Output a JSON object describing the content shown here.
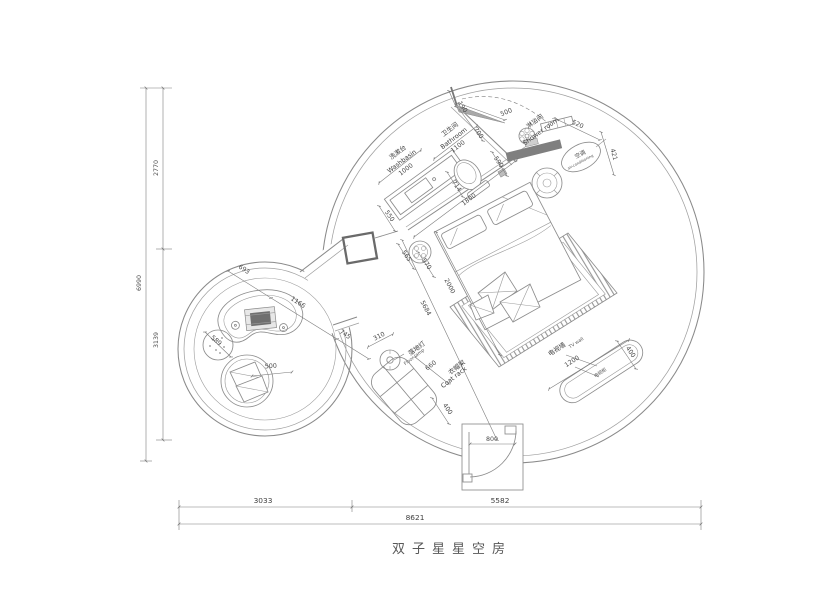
{
  "title": "双子星星空房",
  "colors": {
    "ink": "#6e6e6e",
    "paper": "#ffffff"
  },
  "rooms": {
    "washbasin": {
      "cn": "洗漱台",
      "en": "Washbasin",
      "dim": "1000"
    },
    "bathroom": {
      "cn": "卫生间",
      "en": "Bathroom",
      "dim": "1100"
    },
    "shower": {
      "cn": "淋浴间",
      "en": "Shower room"
    },
    "ac": {
      "cn": "空调",
      "en": "air-conditioning"
    },
    "floor_lamp": {
      "cn": "落地灯",
      "en": "Floor lamp"
    },
    "coat_rack": {
      "cn": "衣帽架",
      "en": "Coat rack"
    },
    "tv_wall": {
      "cn": "电视墙",
      "en": "TV wall"
    },
    "tv_cabinet": {
      "cn": "电视柜"
    }
  },
  "dims": {
    "left_total": "6990",
    "left_top": "2770",
    "left_bottom": "3139",
    "bottom_left": "3033",
    "bottom_right": "5582",
    "bottom_total": "8621",
    "d190": "190",
    "d700": "700",
    "d500_door": "500",
    "d590": "590",
    "d520": "520",
    "d421": "421",
    "d550": "550",
    "d714": "714",
    "d1800": "1800",
    "d565": "565",
    "d570": "570",
    "d2000": "2000",
    "d5684": "5684",
    "d693": "693",
    "d1166": "1166",
    "d745": "745",
    "d589": "589",
    "d500_chair": "500",
    "d310": "310",
    "d660": "660",
    "d400_coat": "400",
    "d1200": "1200",
    "d400_tv": "400",
    "d800": "800"
  }
}
